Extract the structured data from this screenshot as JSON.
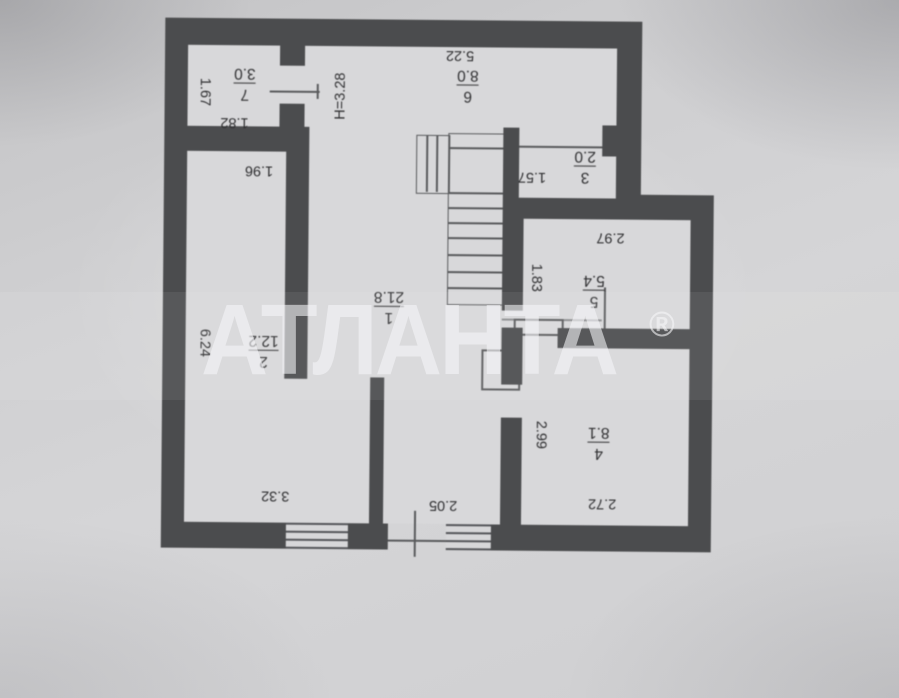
{
  "watermark": {
    "brand": "АТЛАНТА",
    "registered": "®"
  },
  "plan": {
    "height_label": "H=3.28",
    "rooms": [
      {
        "number": "7",
        "area": "3.0"
      },
      {
        "number": "6",
        "area": "8.0"
      },
      {
        "number": "3",
        "area": "2.0"
      },
      {
        "number": "5",
        "area": "5.4"
      },
      {
        "number": "1",
        "area": "21.8"
      },
      {
        "number": "2",
        "area": "12.2"
      },
      {
        "number": "4",
        "area": "8.1"
      }
    ],
    "dimensions": {
      "d167": "1.67",
      "d182": "1.82",
      "d522": "5.22",
      "d157": "1.57",
      "d297": "2.97",
      "d183": "1.83",
      "d205": "2.05",
      "d196": "1.96",
      "d624": "6.24",
      "d332": "3.32",
      "d299": "2.99",
      "d272": "2.72"
    }
  },
  "colors": {
    "wall": "#4b4c4e",
    "paper": "#d8d8da",
    "text": "#2f2f31",
    "watermark": "rgba(247,247,249,0.58)"
  }
}
